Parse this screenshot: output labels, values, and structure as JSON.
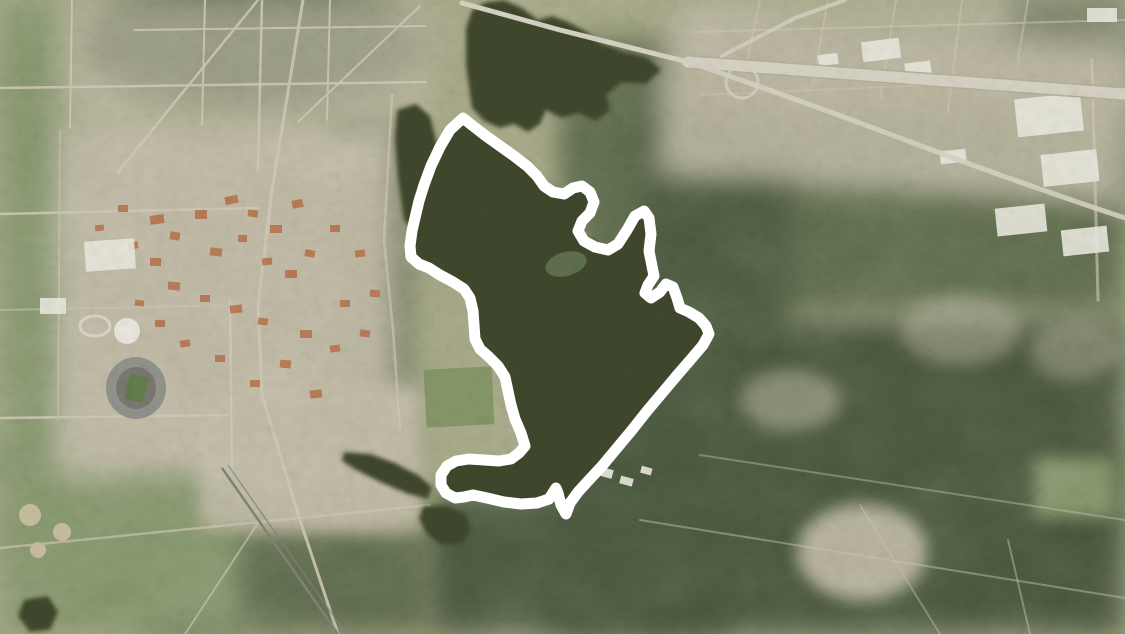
{
  "map": {
    "kind": "satellite-aerial-photo",
    "description": "Aerial satellite photograph of a city: university campus with stadium and white dome at left, residential grids at top, elevated highway interchange at top right, dense forest at lower right, and a dark lake in the center",
    "annotation_label": "white boundary outline drawn around the lake region"
  },
  "colors": {
    "base": "#a3a583",
    "water": "#3d4529",
    "forest_dark": "#47543b",
    "forest_mid": "#5d6b4c",
    "green_field": "#83946a",
    "green_bright": "#7f9162",
    "urban": "#bfb9a3",
    "urban_light": "#d7d3c4",
    "road": "#cfc9b5",
    "highway": "#d6d2c2",
    "highway_edge": "#b4ae9b",
    "roof_orange": "#b5734c",
    "roof_white": "#e9e7dd",
    "stadium_gray": "#90908a",
    "stadium_inner": "#76766e",
    "stadium_field": "#5f7a4a",
    "rail": "#7d8272",
    "island_green": "#5c6b49",
    "outline": "#ffffff"
  },
  "overlay": {
    "outline_points": "463,118 473,126 486,136 500,146 514,156 527,166 537,176 544,186 553,192 564,194 573,188 582,186 590,192 594,202 590,213 582,221 578,231 584,241 595,247 608,250 618,244 627,230 635,216 644,211 649,218 651,234 649,251 652,266 654,276 648,285 645,293 651,298 660,292 666,284 673,287 677,298 680,308 689,312 699,318 706,326 709,334 703,345 692,358 679,373 663,392 647,411 632,430 617,448 602,466 589,480 578,492 570,503 566,514 561,505 558,493 556,488 549,499 537,503 521,504 504,502 487,498 473,495 464,497 455,498 446,493 441,485 441,475 447,466 456,461 469,459 484,460 499,461 511,459 519,453 525,446 521,433 515,419 511,405 508,391 505,377 498,366 489,357 480,349 475,339 474,325 473,311 470,298 464,289 453,282 440,275 429,268 419,264 411,257 410,246 412,231 415,218 419,201 424,185 431,166 440,147 450,130",
    "outline_width": "11",
    "upper_lake_points": "466,28 472,10 486,2 504,0 522,8 538,20 552,16 568,22 585,31 602,44 624,52 648,58 661,70 646,84 622,82 606,95 610,110 596,121 578,113 562,118 546,110 540,124 528,132 514,124 500,128 484,121 472,108 466,66",
    "nw_pocket_points": "397,110 416,104 430,116 437,144 436,176 428,212 415,233 404,220 398,178 395,140",
    "west_lake_points": "344,452 370,454 395,463 418,475 432,487 428,499 408,494 380,482 356,470 342,461",
    "south_pond_points": "424,506 448,506 466,514 471,530 462,543 442,545 427,534 419,518",
    "sw_pond_points": "24,600 48,596 58,612 50,630 30,632 18,616"
  }
}
